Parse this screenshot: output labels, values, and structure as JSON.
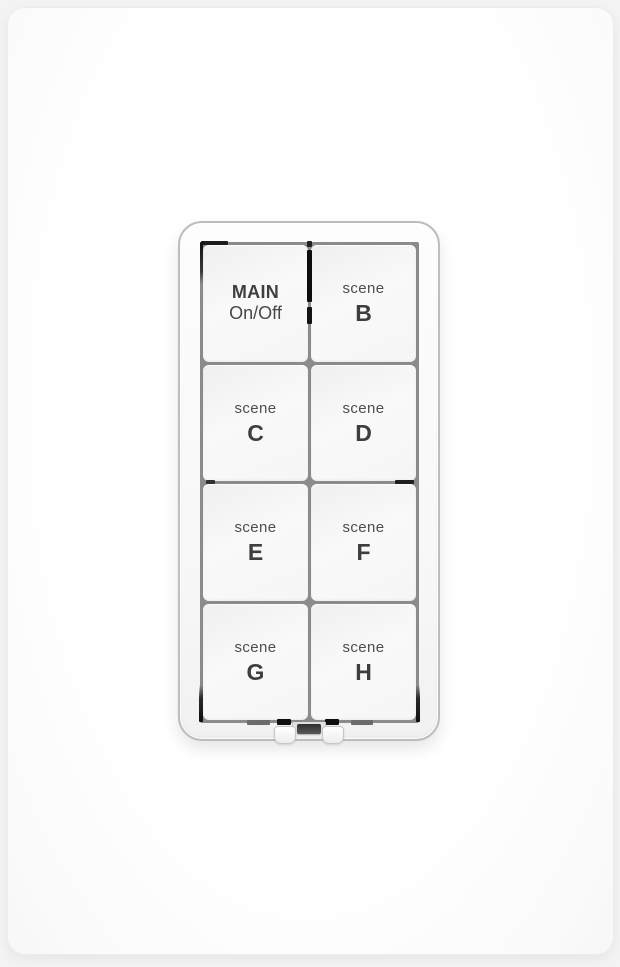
{
  "keypad": {
    "buttons": [
      {
        "id": "main-on-off",
        "top": "MAIN",
        "bottom": "On/Off"
      },
      {
        "id": "scene-b",
        "top": "scene",
        "bottom": "B"
      },
      {
        "id": "scene-c",
        "top": "scene",
        "bottom": "C"
      },
      {
        "id": "scene-d",
        "top": "scene",
        "bottom": "D"
      },
      {
        "id": "scene-e",
        "top": "scene",
        "bottom": "E"
      },
      {
        "id": "scene-f",
        "top": "scene",
        "bottom": "F"
      },
      {
        "id": "scene-g",
        "top": "scene",
        "bottom": "G"
      },
      {
        "id": "scene-h",
        "top": "scene",
        "bottom": "H"
      }
    ]
  },
  "colors": {
    "wall_plate": "#ffffff",
    "bezel_border": "#bdbdbd",
    "grid_line": "#8b8b8b",
    "button_face": "#f7f7f7",
    "label_dark": "#3e3e3e",
    "label_muted": "#4e4e4e",
    "indicator_slot": "#111111",
    "set_button": "#3f3f3f"
  }
}
